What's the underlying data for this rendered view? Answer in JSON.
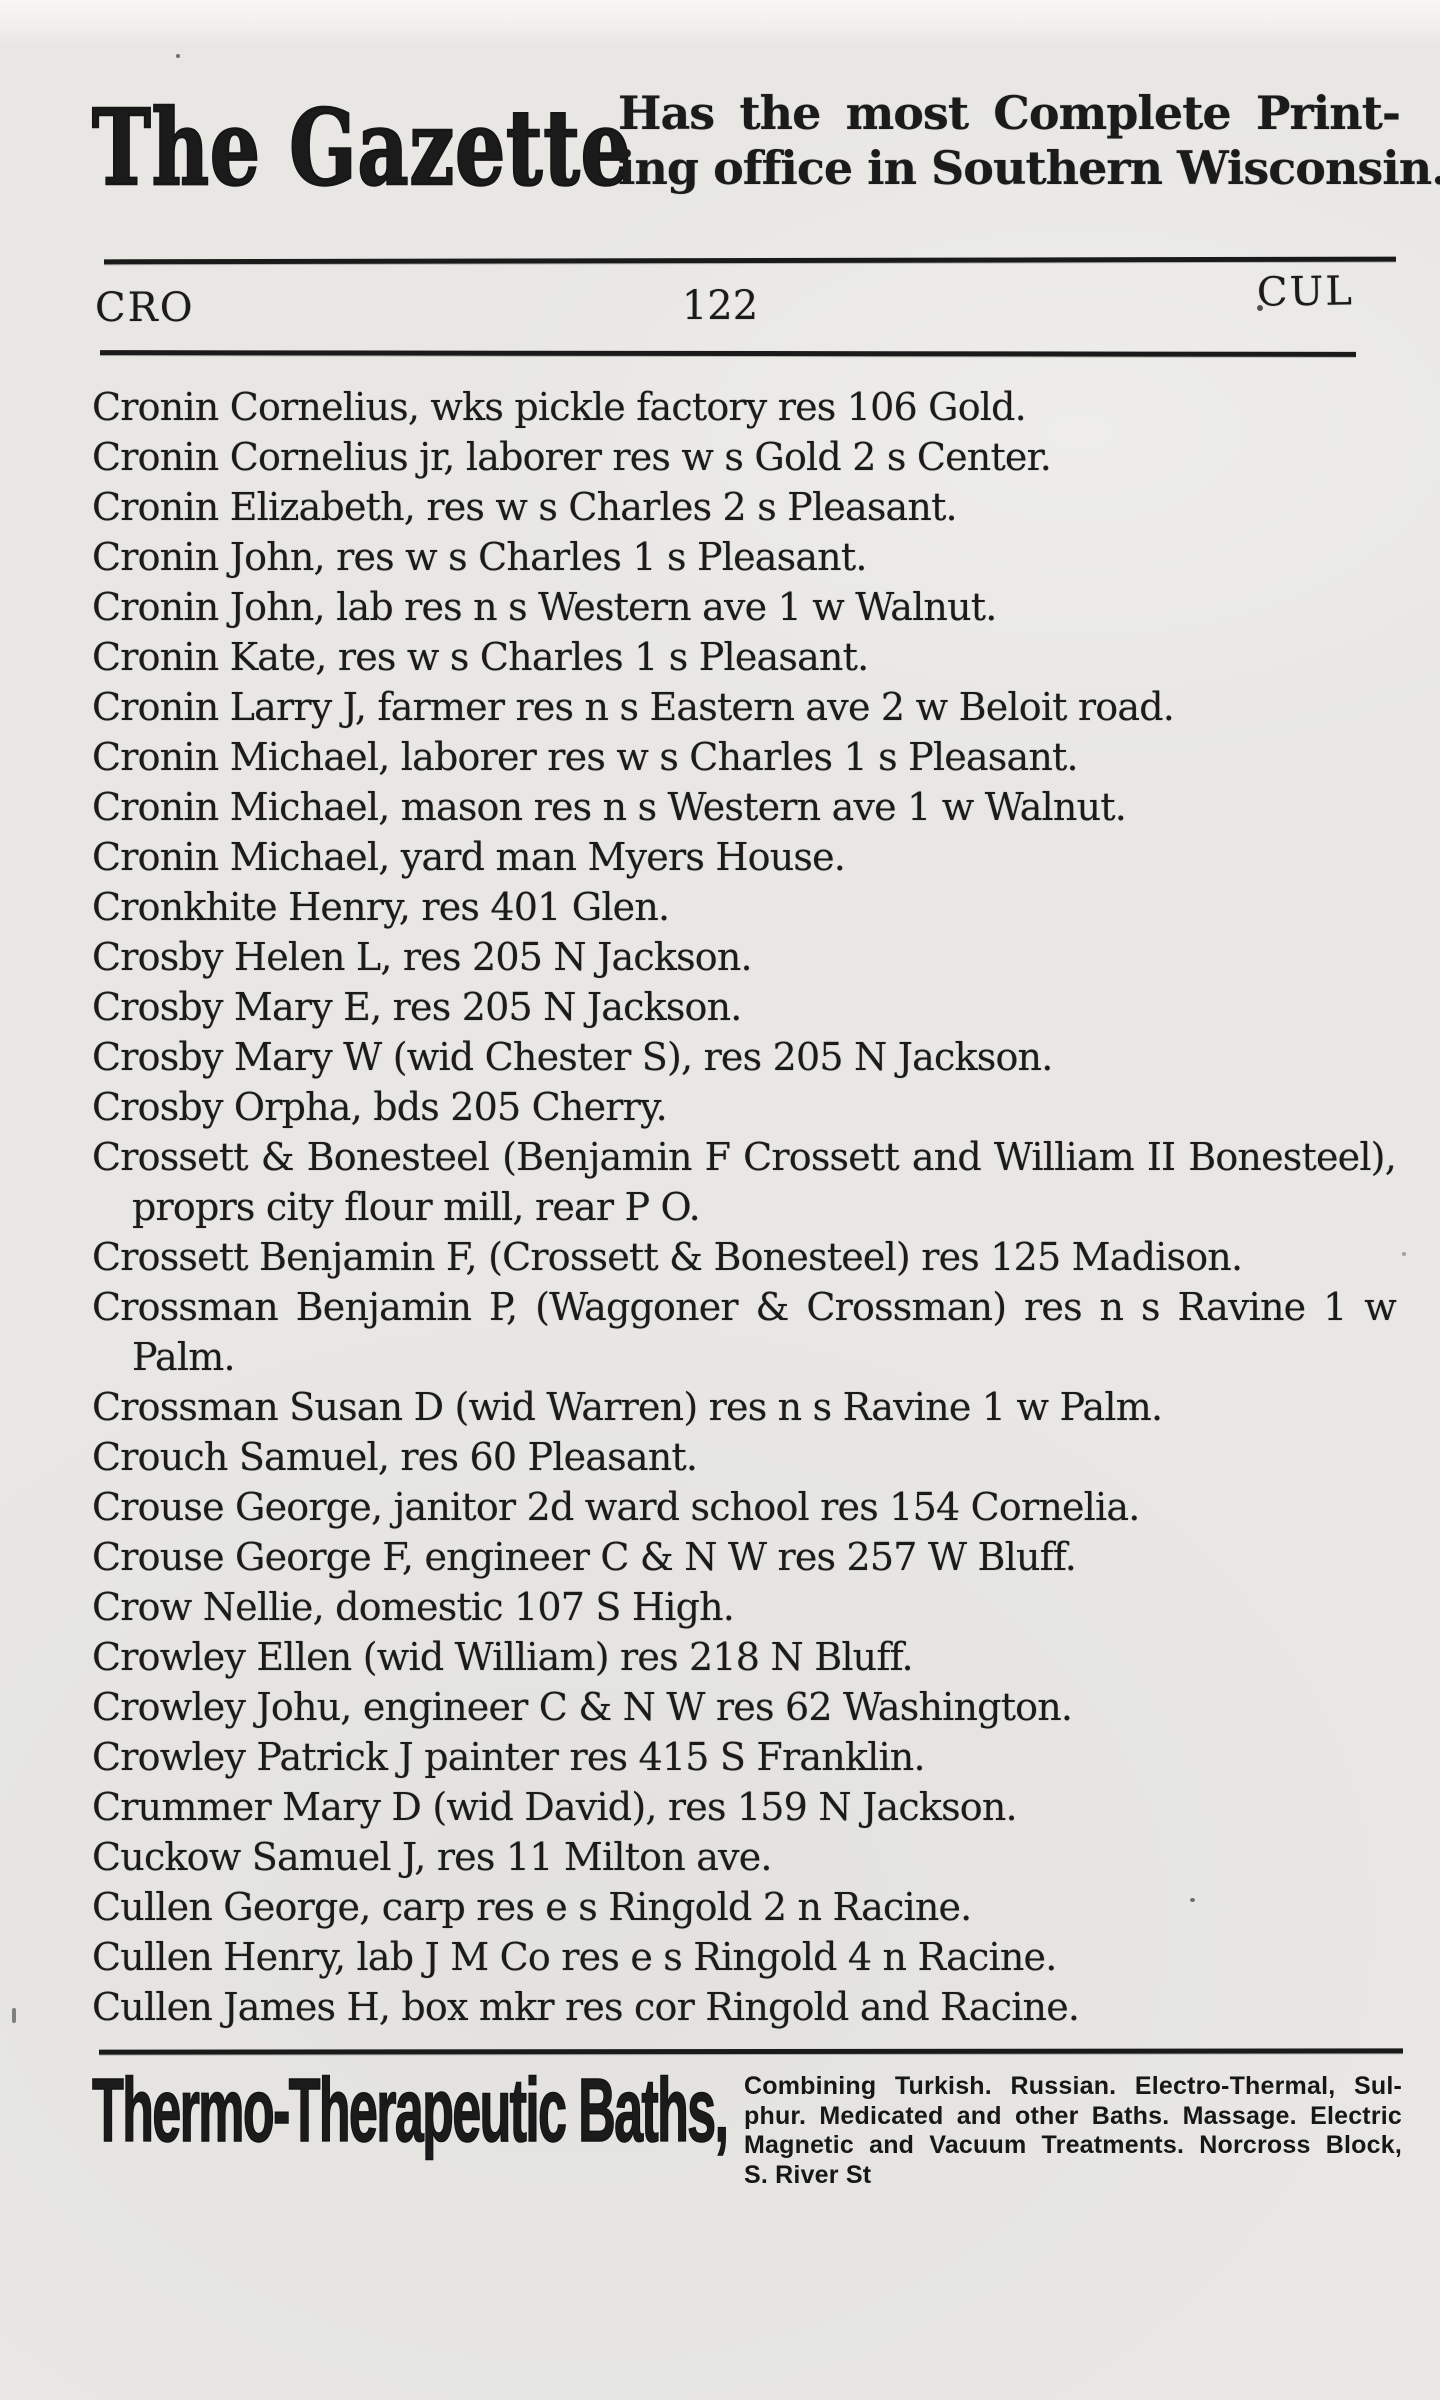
{
  "masthead": {
    "brand": "The Gazette",
    "tagline_lines": [
      "Has the most Complete Print-",
      "ing office in Southern Wisconsin."
    ]
  },
  "page_guide": {
    "left": "CRO",
    "center": "122",
    "right": "CUL"
  },
  "entries": [
    {
      "lines": [
        "Cronin Cornelius, wks pickle factory res 106 Gold."
      ]
    },
    {
      "lines": [
        "Cronin Cornelius jr, laborer res w s Gold 2 s Center."
      ]
    },
    {
      "lines": [
        "Cronin Elizabeth, res w s Charles 2 s Pleasant."
      ]
    },
    {
      "lines": [
        "Cronin John, res w s Charles 1 s Pleasant."
      ]
    },
    {
      "lines": [
        "Cronin John, lab res n s Western ave 1 w Walnut."
      ]
    },
    {
      "lines": [
        "Cronin Kate, res w s Charles 1 s Pleasant."
      ]
    },
    {
      "lines": [
        "Cronin Larry J, farmer res n s Eastern ave 2 w Beloit road."
      ]
    },
    {
      "lines": [
        "Cronin Michael, laborer res w s Charles 1 s Pleasant."
      ]
    },
    {
      "lines": [
        "Cronin Michael, mason res n s Western ave 1 w Walnut."
      ]
    },
    {
      "lines": [
        "Cronin Michael, yard man Myers House."
      ]
    },
    {
      "lines": [
        "Cronkhite Henry, res 401 Glen."
      ]
    },
    {
      "lines": [
        "Crosby Helen L, res 205 N Jackson."
      ]
    },
    {
      "lines": [
        "Crosby Mary E, res 205 N Jackson."
      ]
    },
    {
      "lines": [
        "Crosby Mary W (wid Chester S), res 205 N Jackson."
      ]
    },
    {
      "lines": [
        "Crosby Orpha, bds 205 Cherry."
      ]
    },
    {
      "lines": [
        "Crossett & Bonesteel (Benjamin F Crossett and William II Bonesteel),",
        "proprs city flour mill, rear P O."
      ]
    },
    {
      "lines": [
        "Crossett Benjamin F, (Crossett & Bonesteel) res 125 Madison."
      ]
    },
    {
      "lines": [
        "Crossman Benjamin P, (Waggoner & Crossman) res n s Ravine 1 w",
        "Palm."
      ]
    },
    {
      "lines": [
        "Crossman Susan D (wid Warren) res n s Ravine 1 w Palm."
      ]
    },
    {
      "lines": [
        "Crouch Samuel, res 60 Pleasant."
      ]
    },
    {
      "lines": [
        "Crouse George, janitor 2d ward school res 154 Cornelia."
      ]
    },
    {
      "lines": [
        "Crouse George F, engineer C & N W res 257 W Bluff."
      ]
    },
    {
      "lines": [
        "Crow Nellie, domestic 107 S High."
      ]
    },
    {
      "lines": [
        "Crowley Ellen (wid William) res 218 N Bluff."
      ]
    },
    {
      "lines": [
        "Crowley Johu, engineer C & N W res 62 Washington."
      ]
    },
    {
      "lines": [
        "Crowley Patrick J painter res 415 S Franklin."
      ]
    },
    {
      "lines": [
        "Crummer Mary D (wid David), res 159 N Jackson."
      ]
    },
    {
      "lines": [
        "Cuckow Samuel J, res 11 Milton ave."
      ]
    },
    {
      "lines": [
        "Cullen George, carp res e s Ringold 2 n Racine."
      ]
    },
    {
      "lines": [
        "Cullen Henry, lab J M Co res e s Ringold 4 n Racine."
      ]
    },
    {
      "lines": [
        "Cullen James H, box mkr res cor Ringold and Racine."
      ]
    }
  ],
  "footer_ad": {
    "name": "Thermo-Therapeutic Baths,",
    "details_lines": [
      "Combining Turkish. Russian. Electro-Thermal, Sul-",
      "phur. Medicated and other Baths.  Massage. Electric",
      "Magnetic and Vacuum Treatments.  Norcross Block,",
      "S. River St"
    ]
  }
}
